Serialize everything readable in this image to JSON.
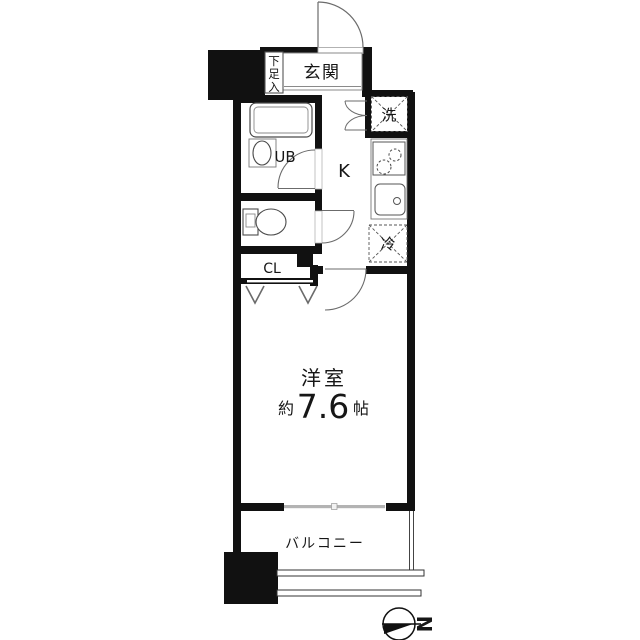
{
  "plan": {
    "entrance": {
      "label": "玄関"
    },
    "shoe_cabinet": {
      "label": "下足入",
      "chars": [
        "下",
        "足",
        "入"
      ]
    },
    "washer": {
      "label": "洗"
    },
    "unit_bath": {
      "label": "UB"
    },
    "kitchen": {
      "label": "K"
    },
    "refrigerator": {
      "label": "冷"
    },
    "closet": {
      "label": "CL"
    },
    "western_room": {
      "label": "洋室",
      "area_prefix": "約",
      "area_value": "7.6",
      "area_unit": "帖"
    },
    "balcony": {
      "label": "バルコニー"
    },
    "compass": {
      "north_label": "N"
    }
  },
  "colors": {
    "wall": "#111111",
    "fixture_line": "#555555",
    "door_line": "#777777",
    "window": "#b3b3b3",
    "text": "#161616"
  }
}
